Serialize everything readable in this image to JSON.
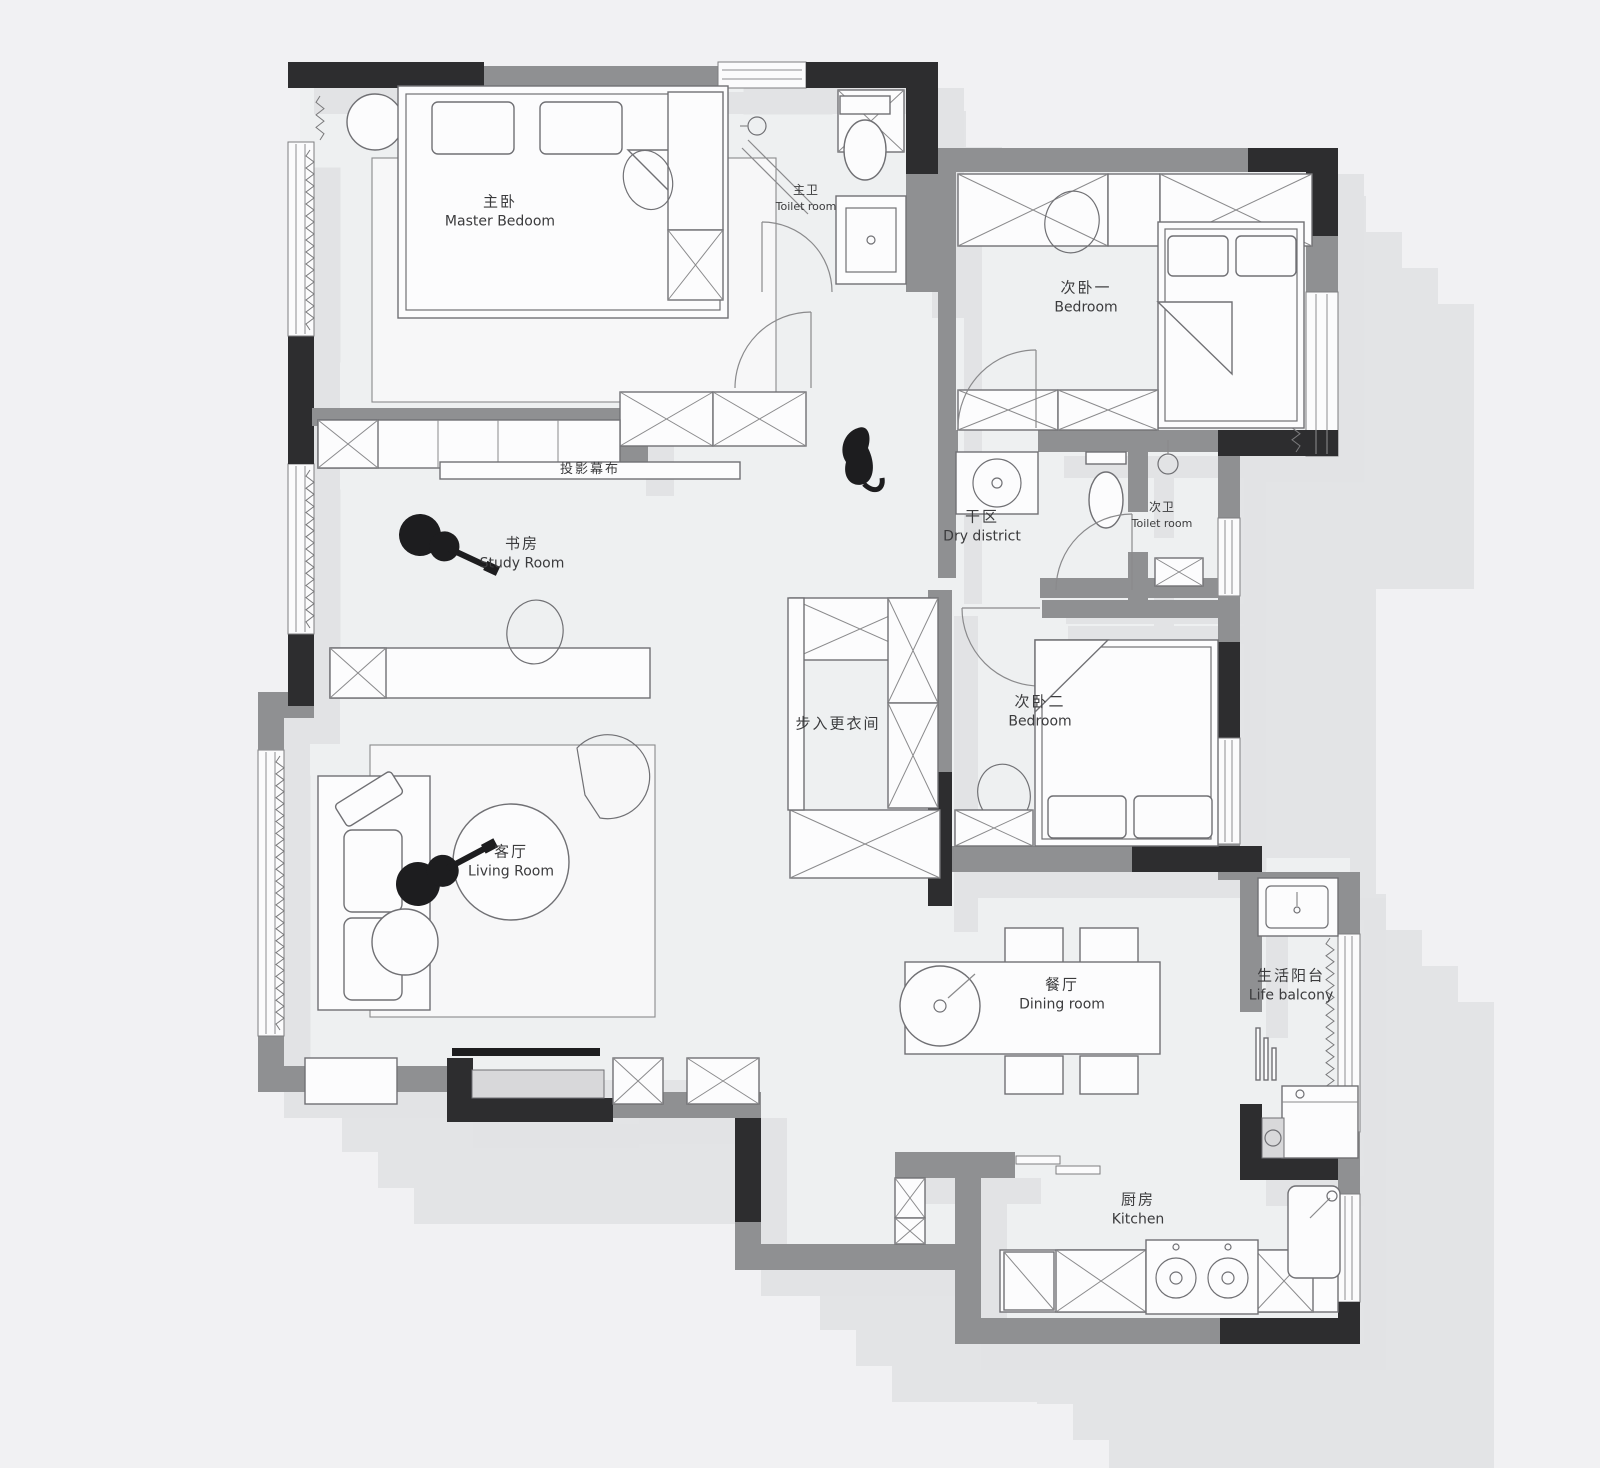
{
  "palette": {
    "wall_dark": "#2d2d2f",
    "wall_gray": "#8f9092",
    "shadow": "#e2e3e5",
    "floor": "#eef0f1",
    "background": "#f1f1f3",
    "ink": "#3b3b3d"
  },
  "rooms": {
    "master_bedroom": {
      "zh": "主卧",
      "en": "Master Bedoom"
    },
    "master_toilet": {
      "zh": "主卫",
      "en": "Toilet room"
    },
    "bedroom_one": {
      "zh": "次卧一",
      "en": "Bedroom"
    },
    "study_room": {
      "zh": "书房",
      "en": "Study Room"
    },
    "projection_screen": {
      "zh": "投影幕布"
    },
    "dry_district": {
      "zh": "干区",
      "en": "Dry district"
    },
    "second_toilet": {
      "zh": "次卫",
      "en": "Toilet room"
    },
    "walk_in_closet": {
      "zh": "步入更衣间"
    },
    "bedroom_two": {
      "zh": "次卧二",
      "en": "Bedroom"
    },
    "living_room": {
      "zh": "客厅",
      "en": "Living Room"
    },
    "dining_room": {
      "zh": "餐厅",
      "en": "Dining room"
    },
    "life_balcony": {
      "zh": "生活阳台",
      "en": "Life balcony"
    },
    "kitchen": {
      "zh": "厨房",
      "en": "Kitchen"
    }
  }
}
